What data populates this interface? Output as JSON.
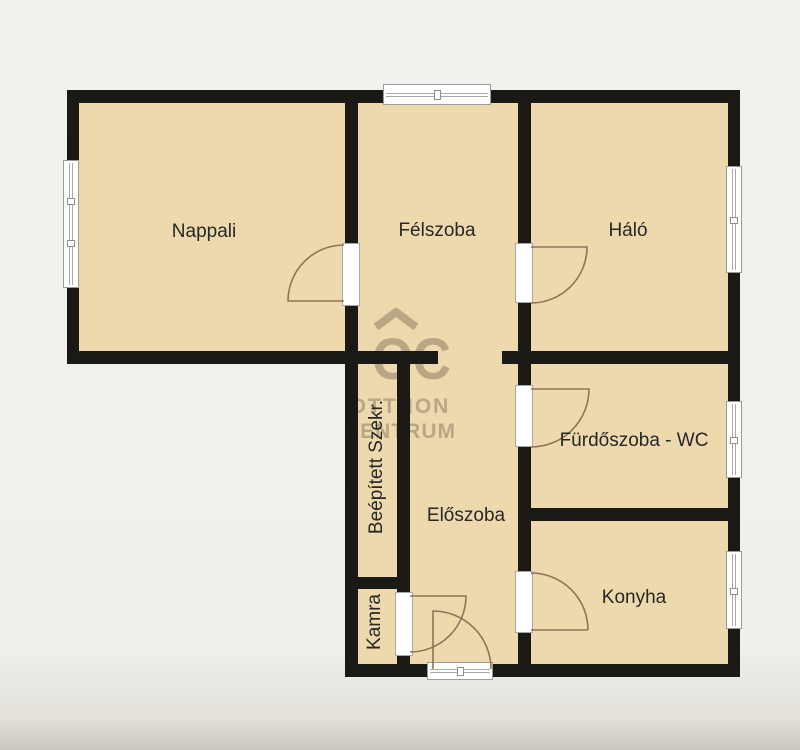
{
  "floorplan": {
    "rooms": {
      "nappali": {
        "label": "Nappali"
      },
      "felszoba": {
        "label": "Félszoba"
      },
      "halo": {
        "label": "Háló"
      },
      "furdoszoba": {
        "label": "Fürdőszoba - WC"
      },
      "eloszoba": {
        "label": "Előszoba"
      },
      "konyha": {
        "label": "Konyha"
      },
      "szekreny": {
        "label": "Beépített Szekr."
      },
      "kamra": {
        "label": "Kamra"
      }
    },
    "watermark": {
      "logo": "OC",
      "line1": "OTTHON",
      "line2": "CENTRUM"
    },
    "colors": {
      "background": "#f1f0ec",
      "room_fill": "#eed9ae",
      "wall": "#1b1916",
      "door_arc": "#8d7458",
      "window_frame": "#9b9b9b",
      "label_text": "#272725",
      "watermark": "#8c7c65"
    }
  }
}
